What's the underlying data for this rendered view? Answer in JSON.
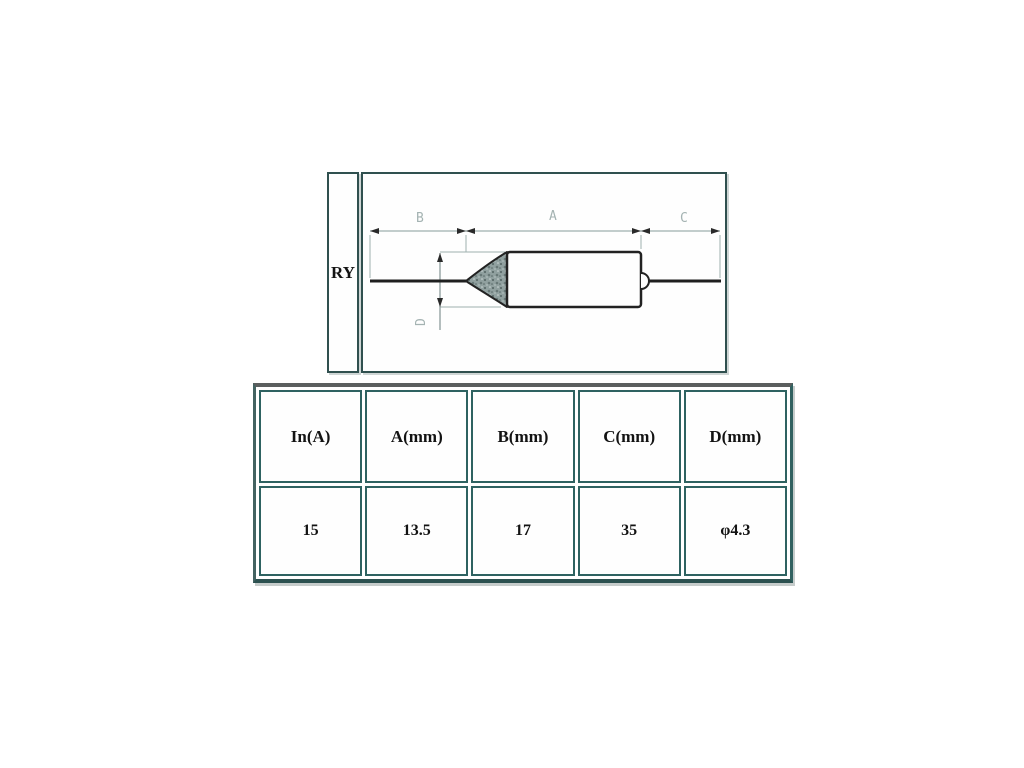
{
  "diagram": {
    "series_label": "RY",
    "dimension_labels": {
      "b": "B",
      "a": "A",
      "c": "C",
      "d": "D"
    },
    "colors": {
      "box_border": "#30504f",
      "drawing_line": "#1f1f1f",
      "dimension_line": "#9fb0af",
      "dimension_text": "#a4b3b2",
      "arrow": "#2a2a2a",
      "cone_fill_base": "#90a09f"
    }
  },
  "table": {
    "columns": [
      {
        "header": "In(A)",
        "value": "15"
      },
      {
        "header": "A(mm)",
        "value": "13.5"
      },
      {
        "header": "B(mm)",
        "value": "17"
      },
      {
        "header": "C(mm)",
        "value": "35"
      },
      {
        "header": "D(mm)",
        "value": "φ4.3"
      }
    ],
    "border_colors": {
      "outer_top": "#5b5e5e",
      "outer_sides": "#316160",
      "cell": "#2e6261"
    }
  }
}
